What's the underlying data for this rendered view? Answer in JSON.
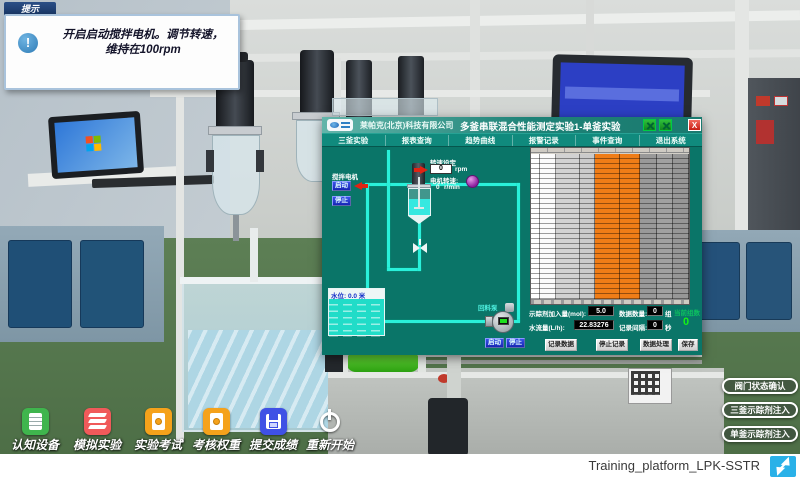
{
  "tooltip": {
    "tab": "提示",
    "icon_glyph": "!",
    "line1": "开启启动搅拌电机。调节转速，",
    "line2": "维持在100rpm"
  },
  "scada": {
    "titlebar": {
      "company": "莱帕克(北京)科技有限公司",
      "title": "多釜串联混合性能测定实验1-单釜实验",
      "close_glyph": "X"
    },
    "menu": [
      "三釜实验",
      "报表查询",
      "趋势曲线",
      "报警记录",
      "事件查询",
      "退出系统"
    ],
    "diagram": {
      "agitator_label": "搅拌电机",
      "agitator_start": "启动",
      "agitator_stop": "停止",
      "speed_set_label": "转速设定",
      "speed_set_value": "0",
      "speed_set_unit": "rpm",
      "motor_speed_label": "电机转速:",
      "motor_speed_value": "0",
      "motor_speed_unit": "r/min",
      "water_level_label": "水位: 0.0 米",
      "pump_label": "回料泵",
      "pump_start": "启动",
      "pump_stop": "停止"
    },
    "table": {
      "highlight_color": "#f07d17",
      "columns": [
        {
          "w": 9,
          "color": "#ffffff"
        },
        {
          "w": 16,
          "color": "#fbfbfb"
        },
        {
          "w": 24,
          "color": "#d2d2d2"
        },
        {
          "w": 15,
          "color": "#cacaca"
        },
        {
          "w": 25,
          "color": "#f07d17"
        },
        {
          "w": 20,
          "color": "#ef7d17"
        },
        {
          "w": 17,
          "color": "#999999"
        },
        {
          "w": 16,
          "color": "#a1a1a1"
        },
        {
          "w": 16,
          "color": "#979797"
        }
      ]
    },
    "params": {
      "tracer_label": "示踪剂加入量(mol):",
      "tracer_value": "5.0",
      "flow_label": "水流量(L/h):",
      "flow_value": "22.83276",
      "count_label": "数据数量:",
      "count_value": "0",
      "count_unit": "组",
      "interval_label": "记录间隔:",
      "interval_value": "0",
      "interval_unit": "秒",
      "current_label": "当前组数",
      "current_value": "0"
    },
    "actions": [
      "记录数据",
      "停止记录",
      "数据处理",
      "保存"
    ]
  },
  "dock": {
    "items": [
      {
        "label": "认知设备",
        "icon": "document-icon",
        "color": "#3fb54d"
      },
      {
        "label": "模拟实验",
        "icon": "layers-icon",
        "color": "#f05a5a"
      },
      {
        "label": "实验考试",
        "icon": "exam-file-icon",
        "color": "#f5a21b"
      },
      {
        "label": "考核权重",
        "icon": "weight-file-icon",
        "color": "#f5a21b"
      },
      {
        "label": "提交成绩",
        "icon": "floppy-icon",
        "color": "#3f51e5"
      },
      {
        "label": "重新开始",
        "icon": "power-icon",
        "color": "transparent"
      }
    ]
  },
  "side_panel": {
    "buttons": [
      "阀门状态确认",
      "三釜示踪剂注入",
      "单釜示踪剂注入"
    ]
  },
  "footer": {
    "label": "Training_platform_LPK-SSTR"
  },
  "colors": {
    "scada_background": "#0a7568",
    "pipe": "#2af0da",
    "table_highlight": "#f07d17",
    "start_stop_button": "#2438d8",
    "floor": "#58794f"
  }
}
